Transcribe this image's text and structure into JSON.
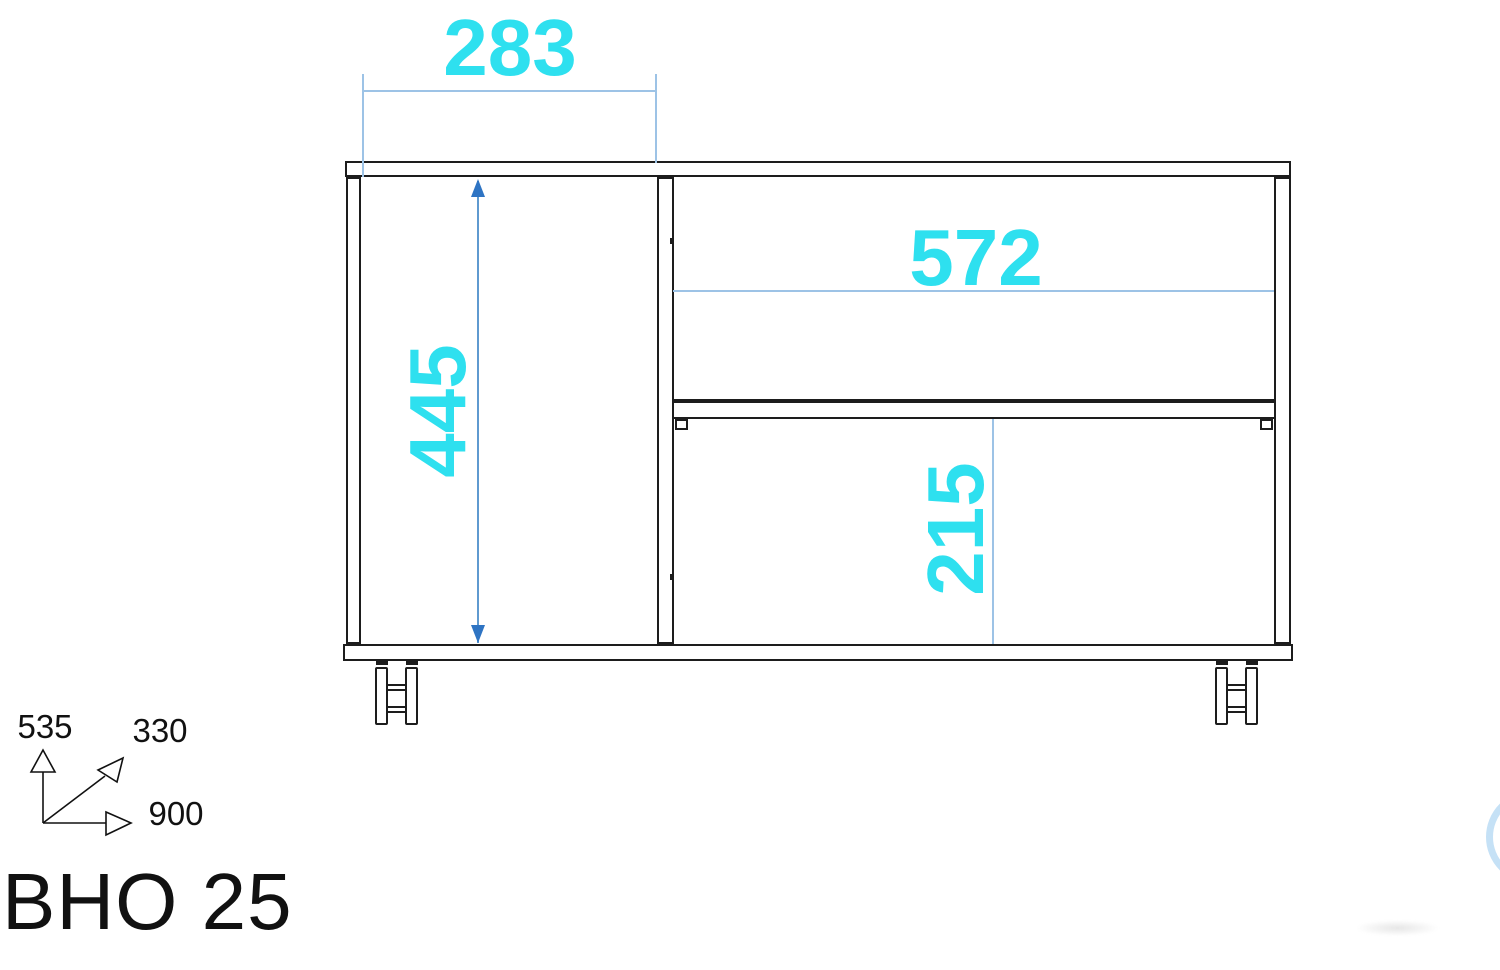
{
  "model_label": "BHO 25",
  "dims": {
    "top_width": "283",
    "left_height": "445",
    "shelf_width": "572",
    "flap_height": "215"
  },
  "axis": {
    "up": "535",
    "diagonal": "330",
    "right": "900"
  },
  "colors": {
    "cyan": "#2EE0EF",
    "dimline": "#9DC3E6",
    "dimline-strong": "#5F9AD0",
    "arrow": "#2E74C3",
    "outline": "#1D1D1D",
    "ink": "#111111"
  }
}
